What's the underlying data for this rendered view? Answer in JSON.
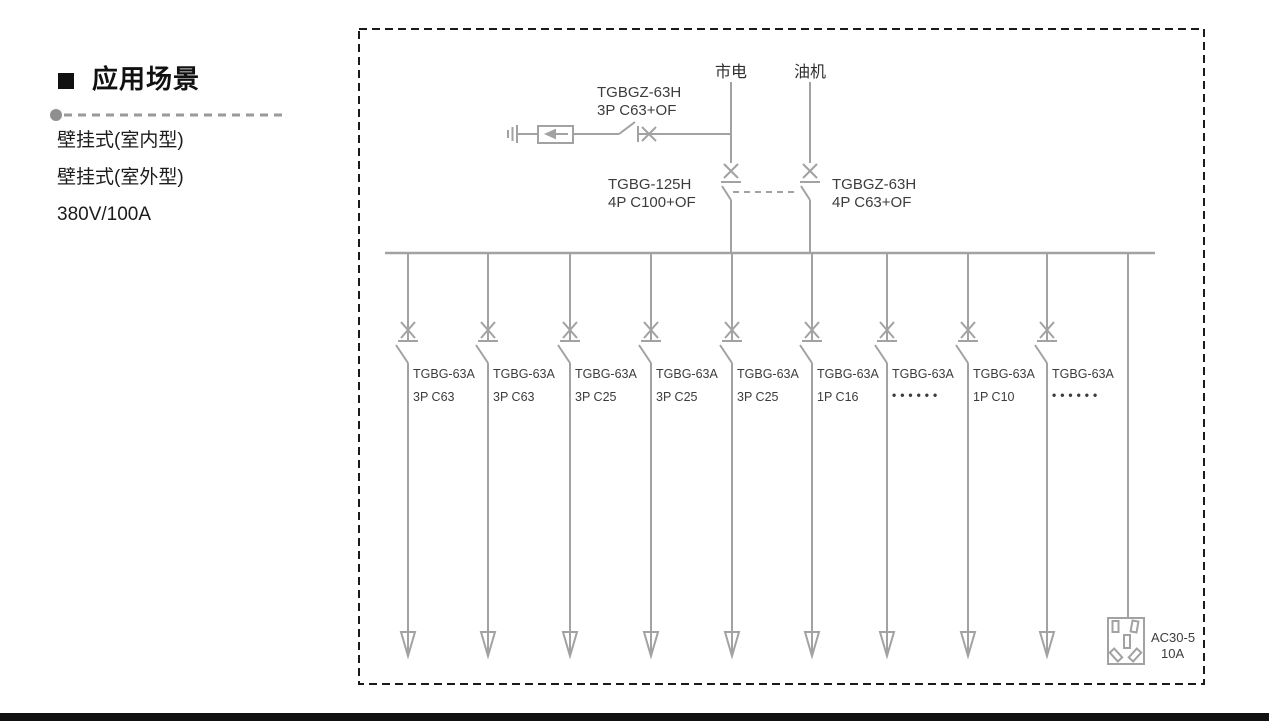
{
  "sidebar": {
    "heading": "应用场景",
    "items": [
      "壁挂式(室内型)",
      "壁挂式(室外型)",
      "380V/100A"
    ]
  },
  "diagram": {
    "sources": {
      "mains": "市电",
      "generator": "油机"
    },
    "spd_breaker": {
      "model": "TGBGZ-63H",
      "rating": "3P C63+OF"
    },
    "mains_breaker": {
      "model": "TGBG-125H",
      "rating": "4P C100+OF"
    },
    "generator_breaker": {
      "model": "TGBGZ-63H",
      "rating": "4P C63+OF"
    },
    "branches": [
      {
        "model": "TGBG-63A",
        "rating": "3P C63"
      },
      {
        "model": "TGBG-63A",
        "rating": "3P C63"
      },
      {
        "model": "TGBG-63A",
        "rating": "3P C25"
      },
      {
        "model": "TGBG-63A",
        "rating": "3P C25"
      },
      {
        "model": "TGBG-63A",
        "rating": "3P C25"
      },
      {
        "model": "TGBG-63A",
        "rating": "1P C16"
      },
      {
        "model": "TGBG-63A",
        "rating": "••••••"
      },
      {
        "model": "TGBG-63A",
        "rating": "1P C10"
      },
      {
        "model": "TGBG-63A",
        "rating": "••••••"
      }
    ],
    "socket": {
      "model": "AC30-5",
      "rating": "10A"
    }
  },
  "colors": {
    "diagram_line": "#a2a2a2",
    "diagram_text": "#3c3c3c",
    "border": "#1a1a1a",
    "bottom_bar": "#101010"
  }
}
